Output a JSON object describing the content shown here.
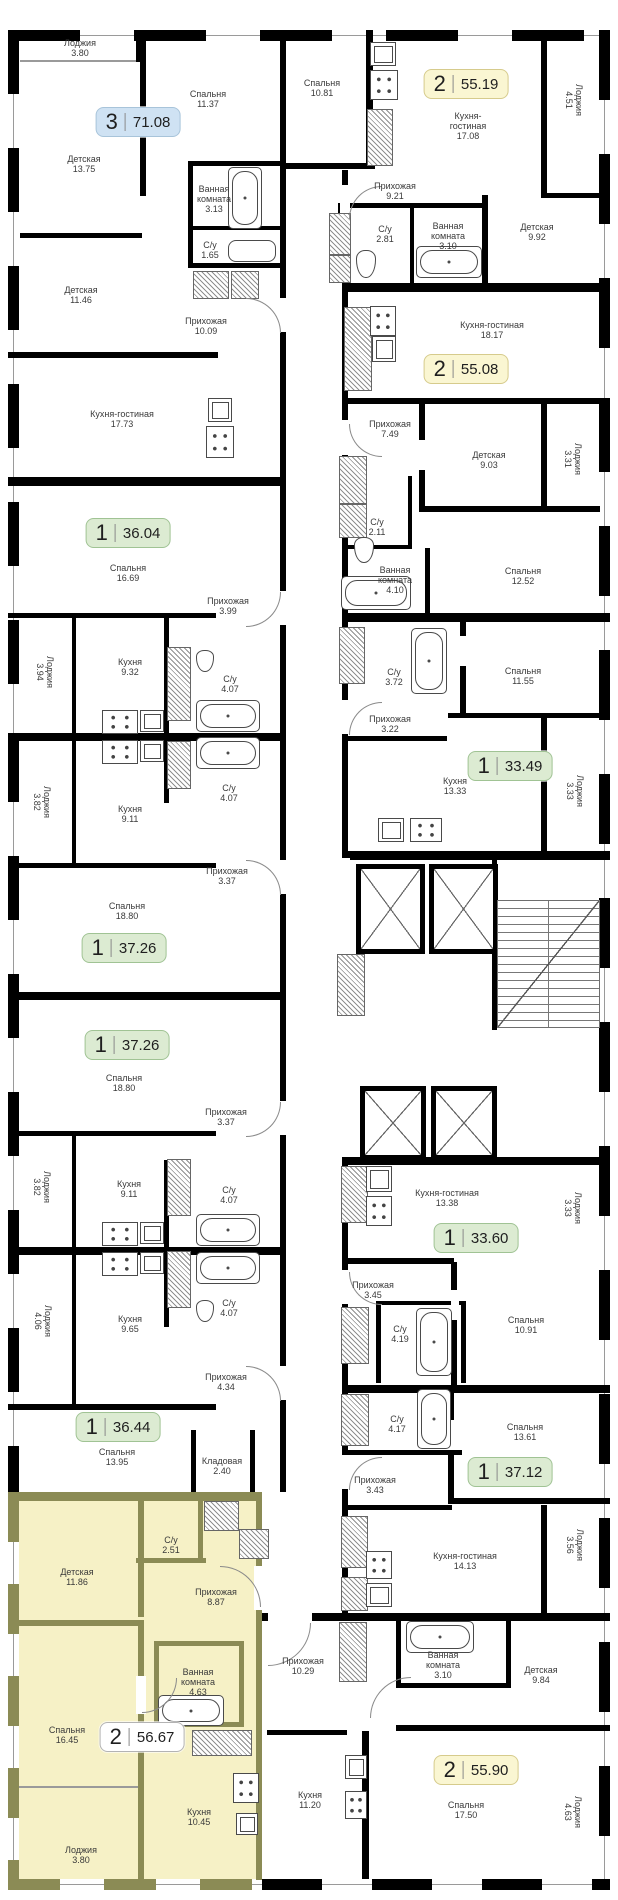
{
  "palette": {
    "one_room": {
      "bg": "#dcebd2",
      "border": "#a0c394"
    },
    "two_room": {
      "bg": "#faf6d2",
      "border": "#d6cb8c"
    },
    "three_room": {
      "bg": "#cfe2f3",
      "border": "#a8c4da"
    },
    "highlight": {
      "bg": "#ffffff",
      "border": "#b3b3b3"
    },
    "highlight_fill": "#f6f1c6",
    "highlight_wall": "#8b8b55",
    "wall": "#000000"
  },
  "apartments": [
    {
      "badge": {
        "rooms": "3",
        "area": "71.08",
        "x": 138,
        "y": 122,
        "style": "three_room"
      },
      "rooms": [
        {
          "label": "Лоджия",
          "area": "3.80",
          "x": 80,
          "y": 48
        },
        {
          "label": "Спальня",
          "area": "11.37",
          "x": 208,
          "y": 99
        },
        {
          "label": "Детская",
          "area": "13.75",
          "x": 84,
          "y": 164
        },
        {
          "label": "Ванная комната",
          "area": "3.13",
          "x": 214,
          "y": 199,
          "w": 56
        },
        {
          "label": "С/у",
          "area": "1.65",
          "x": 210,
          "y": 250
        },
        {
          "label": "Детская",
          "area": "11.46",
          "x": 81,
          "y": 295
        },
        {
          "label": "Прихожая",
          "area": "10.09",
          "x": 206,
          "y": 326
        },
        {
          "label": "Кухня-гостиная",
          "area": "17.73",
          "x": 122,
          "y": 419
        }
      ]
    },
    {
      "badge": {
        "rooms": "2",
        "area": "55.19",
        "x": 466,
        "y": 84,
        "style": "two_room"
      },
      "rooms": [
        {
          "label": "Спальня",
          "area": "10.81",
          "x": 322,
          "y": 88
        },
        {
          "label": "Кухня-гостиная",
          "area": "17.08",
          "x": 468,
          "y": 126,
          "w": 60
        },
        {
          "label": "Лоджия",
          "area": "4.51",
          "x": 574,
          "y": 100,
          "rot": 90
        },
        {
          "label": "Прихожая",
          "area": "9.21",
          "x": 395,
          "y": 191
        },
        {
          "label": "С/у",
          "area": "2.81",
          "x": 385,
          "y": 234
        },
        {
          "label": "Ванная комната",
          "area": "3.10",
          "x": 448,
          "y": 236,
          "w": 58
        },
        {
          "label": "Детская",
          "area": "9.92",
          "x": 537,
          "y": 232
        }
      ]
    },
    {
      "badge": {
        "rooms": "1",
        "area": "36.04",
        "x": 128,
        "y": 533,
        "style": "one_room"
      },
      "rooms": [
        {
          "label": "Спальня",
          "area": "16.69",
          "x": 128,
          "y": 573
        },
        {
          "label": "Прихожая",
          "area": "3.99",
          "x": 228,
          "y": 606
        },
        {
          "label": "Лоджия",
          "area": "3.94",
          "x": 45,
          "y": 672,
          "rot": 90
        },
        {
          "label": "Кухня",
          "area": "9.32",
          "x": 130,
          "y": 667
        },
        {
          "label": "С/у",
          "area": "4.07",
          "x": 230,
          "y": 684
        }
      ]
    },
    {
      "badge": {
        "rooms": "2",
        "area": "55.08",
        "x": 466,
        "y": 369,
        "style": "two_room"
      },
      "rooms": [
        {
          "label": "Кухня-гостиная",
          "area": "18.17",
          "x": 492,
          "y": 330
        },
        {
          "label": "Прихожая",
          "area": "7.49",
          "x": 390,
          "y": 429
        },
        {
          "label": "Детская",
          "area": "9.03",
          "x": 489,
          "y": 460
        },
        {
          "label": "Лоджия",
          "area": "3.31",
          "x": 573,
          "y": 459,
          "rot": 90
        },
        {
          "label": "С/у",
          "area": "2.11",
          "x": 377,
          "y": 527
        },
        {
          "label": "Ванная комната",
          "area": "4.10",
          "x": 395,
          "y": 580,
          "w": 64
        },
        {
          "label": "Спальня",
          "area": "12.52",
          "x": 523,
          "y": 576
        }
      ]
    },
    {
      "badge": {
        "rooms": "1",
        "area": "33.49",
        "x": 510,
        "y": 766,
        "style": "one_room"
      },
      "rooms": [
        {
          "label": "Спальня",
          "area": "11.55",
          "x": 523,
          "y": 676
        },
        {
          "label": "С/у",
          "area": "3.72",
          "x": 394,
          "y": 677
        },
        {
          "label": "Прихожая",
          "area": "3.22",
          "x": 390,
          "y": 724
        },
        {
          "label": "Кухня",
          "area": "13.33",
          "x": 455,
          "y": 786
        },
        {
          "label": "Лоджия",
          "area": "3.33",
          "x": 575,
          "y": 791,
          "rot": 90
        }
      ]
    },
    {
      "badge": {
        "rooms": "1",
        "area": "37.26",
        "x": 124,
        "y": 948,
        "style": "one_room"
      },
      "rooms": [
        {
          "label": "Кухня",
          "area": "9.11",
          "x": 130,
          "y": 814
        },
        {
          "label": "Лоджия",
          "area": "3.82",
          "x": 42,
          "y": 802,
          "rot": 90
        },
        {
          "label": "С/у",
          "area": "4.07",
          "x": 229,
          "y": 793
        },
        {
          "label": "Прихожая",
          "area": "3.37",
          "x": 227,
          "y": 876
        },
        {
          "label": "Спальня",
          "area": "18.80",
          "x": 127,
          "y": 911
        }
      ]
    },
    {
      "badge": {
        "rooms": "1",
        "area": "37.26",
        "x": 127,
        "y": 1045,
        "style": "one_room"
      },
      "rooms": [
        {
          "label": "Спальня",
          "area": "18.80",
          "x": 124,
          "y": 1083
        },
        {
          "label": "Прихожая",
          "area": "3.37",
          "x": 226,
          "y": 1117
        },
        {
          "label": "Кухня",
          "area": "9.11",
          "x": 129,
          "y": 1189
        },
        {
          "label": "Лоджия",
          "area": "3.82",
          "x": 42,
          "y": 1187,
          "rot": 90
        },
        {
          "label": "С/у",
          "area": "4.07",
          "x": 229,
          "y": 1195
        }
      ]
    },
    {
      "badge": {
        "rooms": "1",
        "area": "33.60",
        "x": 476,
        "y": 1238,
        "style": "one_room"
      },
      "rooms": [
        {
          "label": "Кухня-гостиная",
          "area": "13.38",
          "x": 447,
          "y": 1198,
          "w": 64
        },
        {
          "label": "Лоджия",
          "area": "3.33",
          "x": 573,
          "y": 1208,
          "rot": 90
        },
        {
          "label": "Прихожая",
          "area": "3.45",
          "x": 373,
          "y": 1290
        },
        {
          "label": "С/у",
          "area": "4.19",
          "x": 400,
          "y": 1334
        },
        {
          "label": "Спальня",
          "area": "10.91",
          "x": 526,
          "y": 1325
        }
      ]
    },
    {
      "badge": {
        "rooms": "1",
        "area": "36.44",
        "x": 118,
        "y": 1427,
        "style": "one_room"
      },
      "rooms": [
        {
          "label": "Кухня",
          "area": "9.65",
          "x": 130,
          "y": 1324
        },
        {
          "label": "Лоджия",
          "area": "4.06",
          "x": 43,
          "y": 1321,
          "rot": 90
        },
        {
          "label": "С/у",
          "area": "4.07",
          "x": 229,
          "y": 1308
        },
        {
          "label": "Прихожая",
          "area": "4.34",
          "x": 226,
          "y": 1382
        },
        {
          "label": "Спальня",
          "area": "13.95",
          "x": 117,
          "y": 1457
        },
        {
          "label": "Кладовая",
          "area": "2.40",
          "x": 222,
          "y": 1466
        }
      ]
    },
    {
      "badge": {
        "rooms": "1",
        "area": "37.12",
        "x": 510,
        "y": 1472,
        "style": "one_room"
      },
      "rooms": [
        {
          "label": "С/у",
          "area": "4.17",
          "x": 397,
          "y": 1424
        },
        {
          "label": "Спальня",
          "area": "13.61",
          "x": 525,
          "y": 1432
        },
        {
          "label": "Прихожая",
          "area": "3.43",
          "x": 375,
          "y": 1485
        },
        {
          "label": "Кухня-гостиная",
          "area": "14.13",
          "x": 465,
          "y": 1561
        },
        {
          "label": "Лоджия",
          "area": "3.56",
          "x": 575,
          "y": 1545,
          "rot": 90
        }
      ]
    },
    {
      "badge": {
        "rooms": "2",
        "area": "56.67",
        "x": 142,
        "y": 1737,
        "style": "highlight"
      },
      "rooms": [
        {
          "label": "С/у",
          "area": "2.51",
          "x": 171,
          "y": 1545
        },
        {
          "label": "Детская",
          "area": "11.86",
          "x": 77,
          "y": 1577
        },
        {
          "label": "Прихожая",
          "area": "8.87",
          "x": 216,
          "y": 1597
        },
        {
          "label": "Ванная комната",
          "area": "4.63",
          "x": 198,
          "y": 1682,
          "w": 64
        },
        {
          "label": "Спальня",
          "area": "16.45",
          "x": 67,
          "y": 1735
        },
        {
          "label": "Кухня",
          "area": "10.45",
          "x": 199,
          "y": 1817
        },
        {
          "label": "Лоджия",
          "area": "3.80",
          "x": 81,
          "y": 1855
        }
      ]
    },
    {
      "badge": {
        "rooms": "2",
        "area": "55.90",
        "x": 476,
        "y": 1770,
        "style": "two_room"
      },
      "rooms": [
        {
          "label": "Прихожая",
          "area": "10.29",
          "x": 303,
          "y": 1666
        },
        {
          "label": "Ванная комната",
          "area": "3.10",
          "x": 443,
          "y": 1665,
          "w": 64
        },
        {
          "label": "Детская",
          "area": "9.84",
          "x": 541,
          "y": 1675
        },
        {
          "label": "Кухня",
          "area": "11.20",
          "x": 310,
          "y": 1800
        },
        {
          "label": "Спальня",
          "area": "17.50",
          "x": 466,
          "y": 1810
        },
        {
          "label": "Лоджия",
          "area": "4.63",
          "x": 573,
          "y": 1812,
          "rot": 90
        }
      ]
    }
  ]
}
